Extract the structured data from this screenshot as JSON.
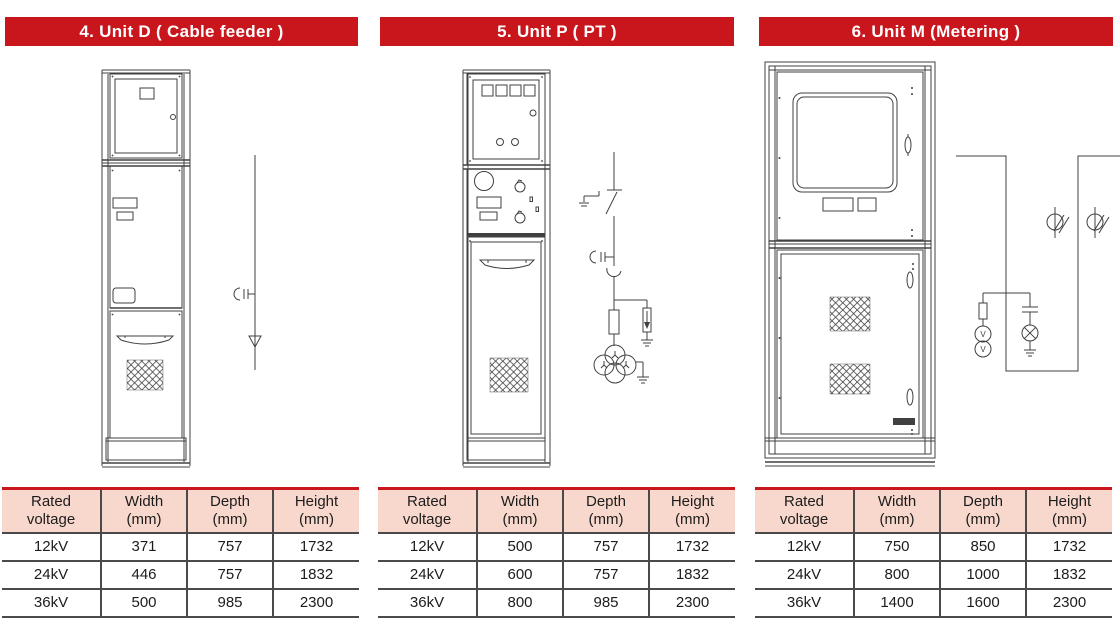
{
  "colors": {
    "banner_red": "#c9161d",
    "banner_text": "#ffffff",
    "table_header_bg": "#f8d8cc",
    "table_border": "#4a4a4a",
    "drawing_line": "#404040"
  },
  "schematic_labels": {
    "voltmeter": "V"
  },
  "panels": [
    {
      "id": "unit-d",
      "title": "4. Unit D ( Cable feeder )",
      "table": {
        "headers": [
          {
            "line1": "Rated",
            "line2": "voltage"
          },
          {
            "line1": "Width",
            "line2": "(mm)"
          },
          {
            "line1": "Depth",
            "line2": "(mm)"
          },
          {
            "line1": "Height",
            "line2": "(mm)"
          }
        ],
        "rows": [
          [
            "12kV",
            "371",
            "757",
            "1732"
          ],
          [
            "24kV",
            "446",
            "757",
            "1832"
          ],
          [
            "36kV",
            "500",
            "985",
            "2300"
          ]
        ]
      }
    },
    {
      "id": "unit-p",
      "title": "5. Unit P ( PT )",
      "table": {
        "headers": [
          {
            "line1": "Rated",
            "line2": "voltage"
          },
          {
            "line1": "Width",
            "line2": "(mm)"
          },
          {
            "line1": "Depth",
            "line2": "(mm)"
          },
          {
            "line1": "Height",
            "line2": "(mm)"
          }
        ],
        "rows": [
          [
            "12kV",
            "500",
            "757",
            "1732"
          ],
          [
            "24kV",
            "600",
            "757",
            "1832"
          ],
          [
            "36kV",
            "800",
            "985",
            "2300"
          ]
        ]
      }
    },
    {
      "id": "unit-m",
      "title": "6. Unit M (Metering )",
      "table": {
        "headers": [
          {
            "line1": "Rated",
            "line2": "voltage"
          },
          {
            "line1": "Width",
            "line2": "(mm)"
          },
          {
            "line1": "Depth",
            "line2": "(mm)"
          },
          {
            "line1": "Height",
            "line2": "(mm)"
          }
        ],
        "rows": [
          [
            "12kV",
            "750",
            "850",
            "1732"
          ],
          [
            "24kV",
            "800",
            "1000",
            "1832"
          ],
          [
            "36kV",
            "1400",
            "1600",
            "2300"
          ]
        ]
      }
    }
  ]
}
